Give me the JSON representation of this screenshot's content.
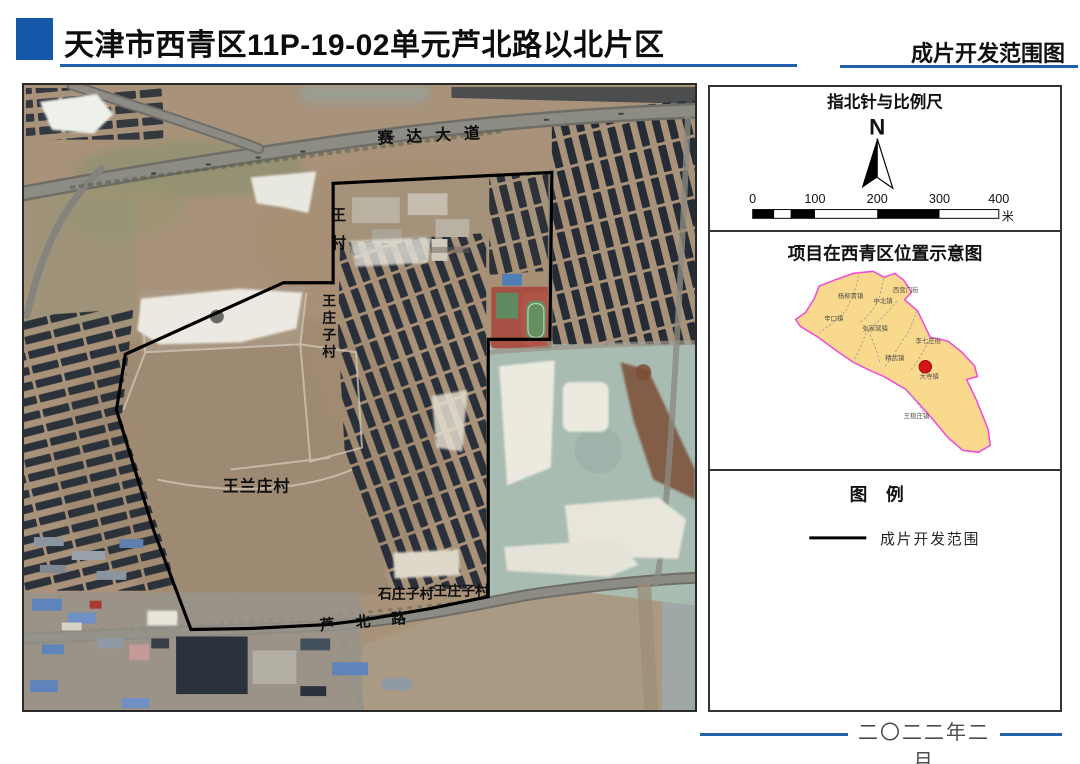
{
  "header": {
    "title": "天津市西青区11P-19-02单元芦北路以北片区",
    "subtitle_right": "成片开发范围图"
  },
  "map": {
    "road_labels": {
      "seda_avenue": "赛达大道",
      "lubei_road": "芦北路"
    },
    "village_labels": {
      "wang_village_chars": [
        "王",
        "村"
      ],
      "wangzhuangzi_vertical_chars": [
        "王",
        "庄",
        "子",
        "村"
      ],
      "wanglanzhuang": "王兰庄村",
      "shizhuangzi": "石庄子村",
      "wangzhuangzi": "王庄子村"
    }
  },
  "north_panel": {
    "title": "指北针与比例尺",
    "north_letter": "N",
    "ticks": [
      "0",
      "100",
      "200",
      "300",
      "400"
    ],
    "unit": "米"
  },
  "location_panel": {
    "title": "项目在西青区位置示意图",
    "towns": [
      "西营门街",
      "杨柳青镇",
      "中北镇",
      "辛口镇",
      "张家窝镇",
      "李七庄街",
      "精武镇",
      "大寺镇",
      "王稳庄镇"
    ]
  },
  "legend_panel": {
    "title": "图 例",
    "items": [
      {
        "label": "成片开发范围"
      }
    ]
  },
  "footer": {
    "date": "二〇二二年二月"
  },
  "colors": {
    "accent_blue": "#1f5fae",
    "title_square_blue": "#1558aa",
    "boundary_black": "#000000",
    "district_fill": "#f9d98d",
    "district_border": "#ee4fd8",
    "marker_red": "#d21414",
    "footer_line_blue": "#2463a8"
  }
}
